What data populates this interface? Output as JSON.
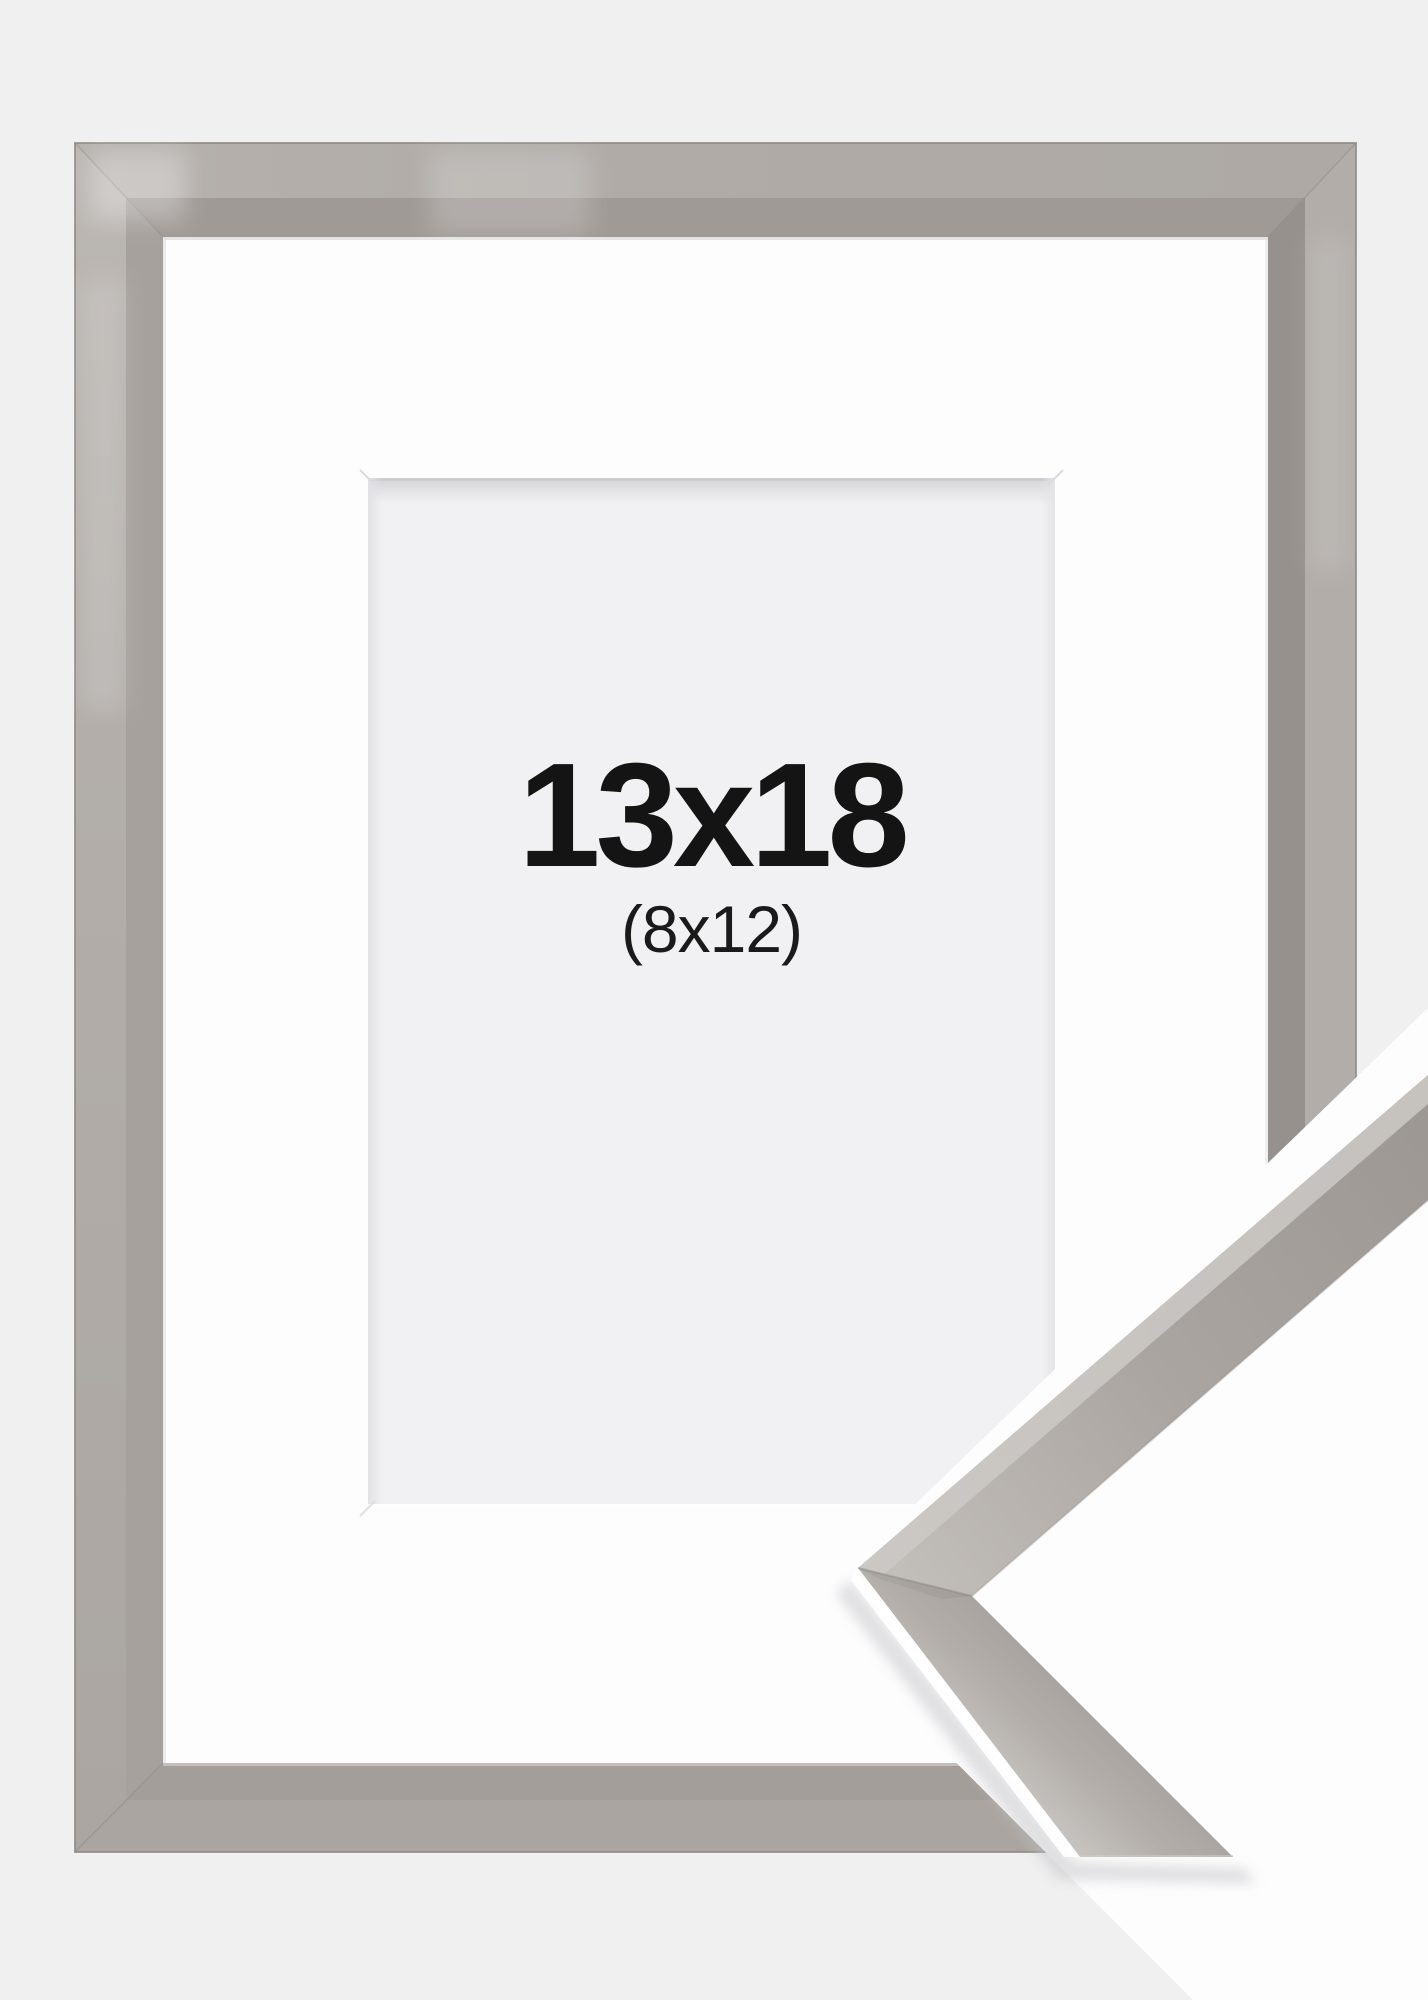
{
  "product_image": {
    "size_label": "13x18",
    "inner_size_label": "(8x12)"
  },
  "colors": {
    "background": "#f0f0f1",
    "mat": "#fdfdfe",
    "opening": "#f1f1f3",
    "frame_face_top": "#b1aca8",
    "frame_face_left": "#b4afab",
    "frame_face_right": "#b2ada9",
    "frame_face_bottom": "#aaa5a1",
    "frame_bevel_top": "#a09a96",
    "frame_bevel_left": "#a6a19d",
    "frame_bevel_right": "#96918c",
    "frame_bevel_bottom": "#a39e9a",
    "frame_outer_edge": "#8d8883",
    "overlay_white": "#fdfdfe",
    "sample_highlight": "#cdc9c6",
    "text": "#141414"
  }
}
